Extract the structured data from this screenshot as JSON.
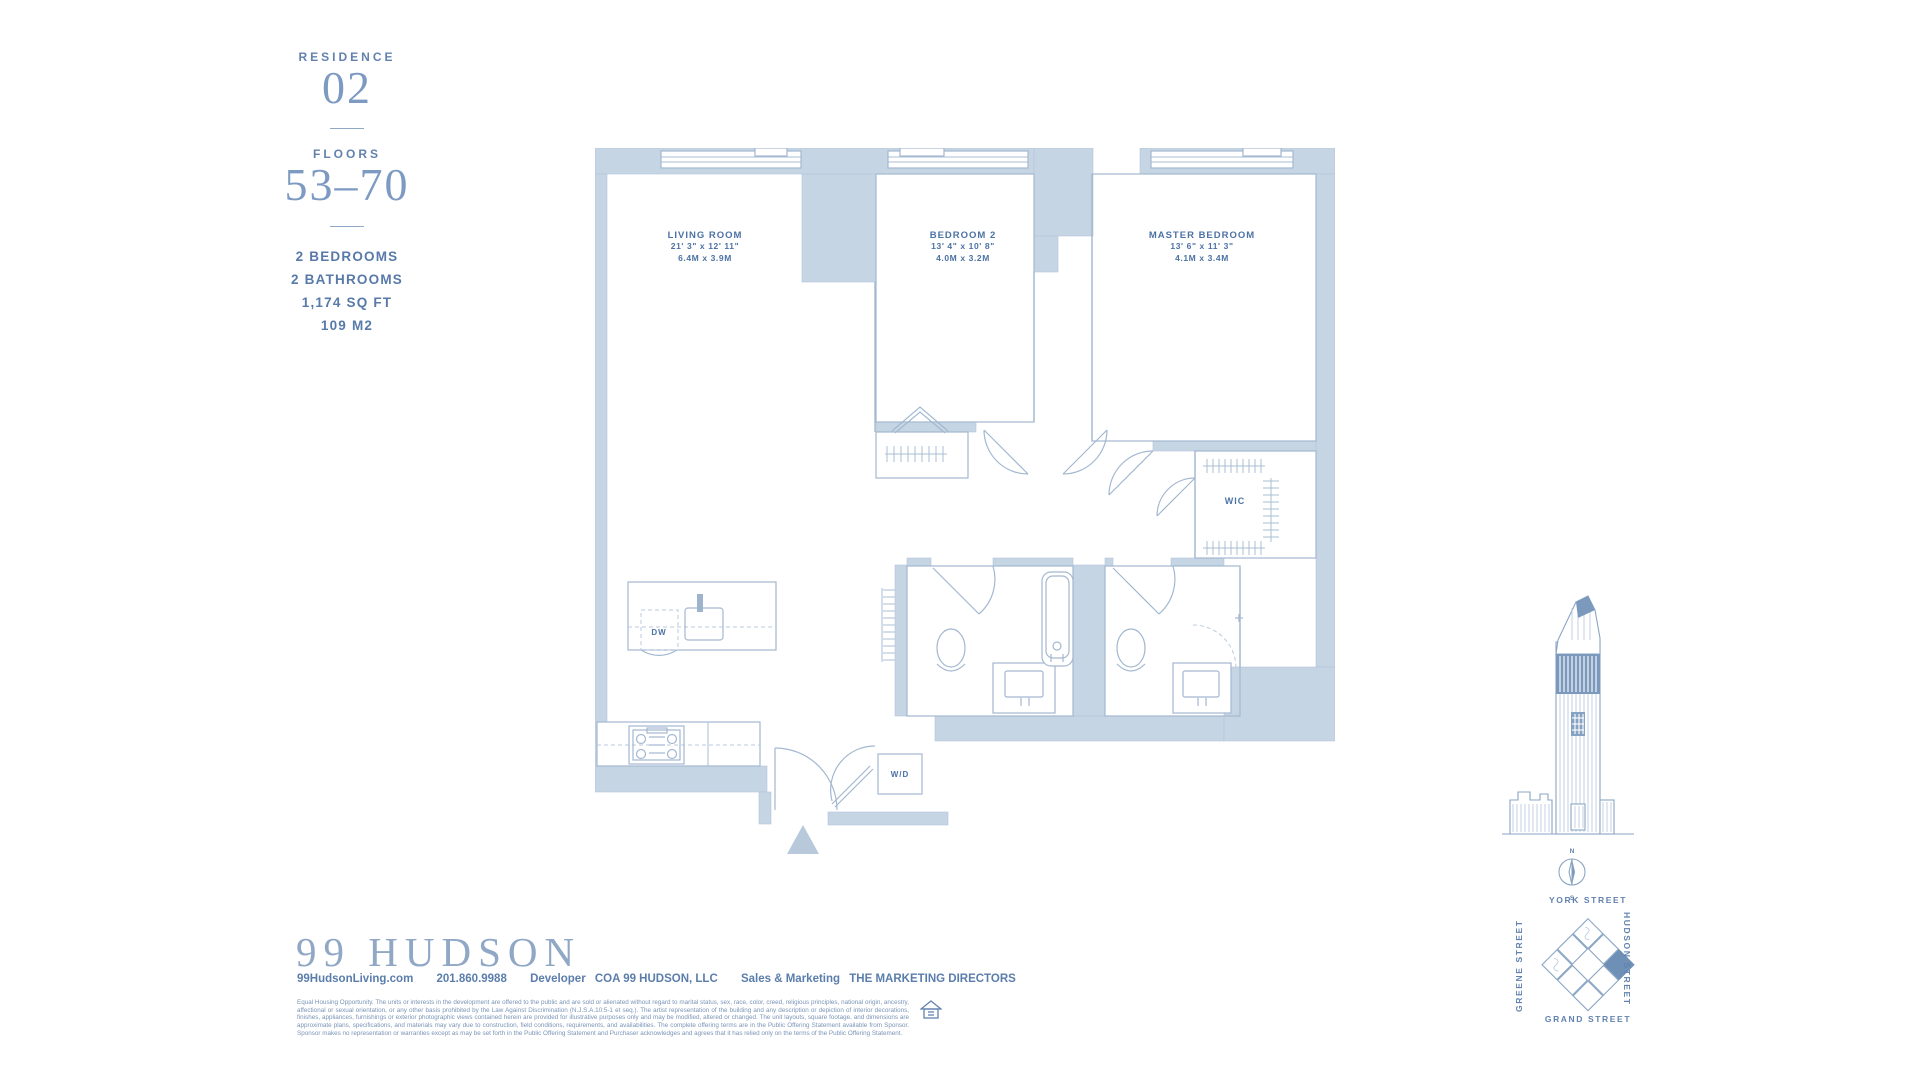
{
  "colors": {
    "ink": "#5b7dac",
    "wall": "#c6d5e4",
    "accent": "#7b99bd"
  },
  "sidebar": {
    "residence_label": "RESIDENCE",
    "residence_number": "02",
    "floors_label": "FLOORS",
    "floors_range": "53–70",
    "specs": [
      "2 BEDROOMS",
      "2 BATHROOMS",
      "1,174 SQ FT",
      "109 M2"
    ]
  },
  "floorplan": {
    "rooms": [
      {
        "name": "LIVING ROOM",
        "imperial": "21' 3\" x 12' 11\"",
        "metric": "6.4M x 3.9M"
      },
      {
        "name": "BEDROOM 2",
        "imperial": "13' 4\" x 10' 8\"",
        "metric": "4.0M x 3.2M"
      },
      {
        "name": "MASTER BEDROOM",
        "imperial": "13' 6\" x 11' 3\"",
        "metric": "4.1M x 3.4M"
      }
    ],
    "labels": {
      "wic": "WIC",
      "dw": "DW",
      "wd": "W/D"
    }
  },
  "locator": {
    "compass": {
      "north": "N",
      "south": "S"
    },
    "streets": {
      "top": "YORK STREET",
      "bottom": "GRAND STREET",
      "left": "GREENE STREET",
      "right": "HUDSON STREET"
    }
  },
  "footer": {
    "logo": "99 HUDSON",
    "website": "99HudsonLiving.com",
    "phone": "201.860.9988",
    "developer_label": "Developer",
    "developer_name": "COA 99 HUDSON, LLC",
    "sales_label": "Sales & Marketing",
    "sales_name": "THE MARKETING DIRECTORS",
    "disclaimer": "Equal Housing Opportunity. The units or interests in the development are offered to the public and are sold or alienated without regard to marital status, sex, race, color, creed, religious principles, national origin, ancestry, affectional or sexual orientation, or any other basis prohibited by the Law Against Discrimination (N.J.S.A.10:5-1 et seq.). The artist representation of the building and any description or depiction of interior decorations, finishes, appliances, furnishings or exterior photographic views contained herein are provided for illustrative purposes only and may be modified, altered or changed. The unit layouts, square footage, and dimensions are approximate plans, specifications, and materials may vary due to construction, field conditions, requirements, and availabilities. The complete offering terms are in the Public Offering Statement available from Sponsor. Sponsor makes no representation or warranties except as may be set forth in the Public Offering Statement and Purchaser acknowledges and agrees that it has relied only on the terms of the Public Offering Statement."
  }
}
